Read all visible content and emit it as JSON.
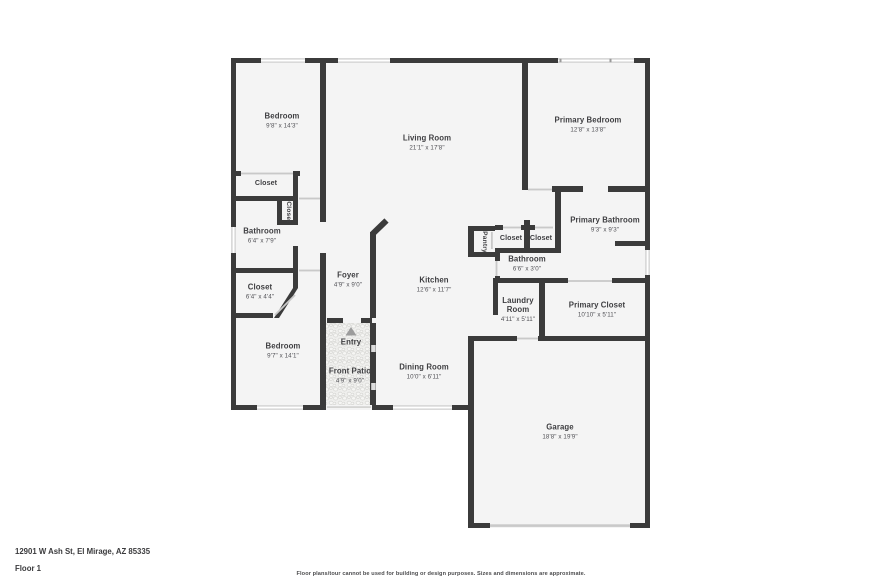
{
  "meta": {
    "address": "12901 W Ash St, El Mirage, AZ 85335",
    "floor_label": "Floor 1",
    "disclaimer": "Floor plans/tour cannot be used for building or design purposes. Sizes and dimensions are approximate."
  },
  "rooms": {
    "bedroom_front": {
      "name": "Bedroom",
      "dims": "9'8\" x 14'3\""
    },
    "living_room": {
      "name": "Living Room",
      "dims": "21'1\" x 17'8\""
    },
    "primary_bedroom": {
      "name": "Primary Bedroom",
      "dims": "12'8\" x 13'8\""
    },
    "bedroom_closet": {
      "name": "Closet"
    },
    "hall_closet_side": {
      "name": "Closet"
    },
    "bathroom_hall": {
      "name": "Bathroom",
      "dims": "6'4\" x 7'9\""
    },
    "closet_hall": {
      "name": "Closet",
      "dims": "6'4\" x 4'4\""
    },
    "bedroom_back": {
      "name": "Bedroom",
      "dims": "9'7\" x 14'1\""
    },
    "foyer": {
      "name": "Foyer",
      "dims": "4'9\" x 9'0\""
    },
    "entry": {
      "name": "Entry"
    },
    "front_patio": {
      "name": "Front Patio",
      "dims": "4'9\" x 9'0\""
    },
    "kitchen": {
      "name": "Kitchen",
      "dims": "12'6\" x 11'7\""
    },
    "dining_room": {
      "name": "Dining Room",
      "dims": "10'0\" x 6'11\""
    },
    "pantry": {
      "name": "Pantry"
    },
    "closet_a": {
      "name": "Closet"
    },
    "closet_b": {
      "name": "Closet"
    },
    "bathroom_small": {
      "name": "Bathroom",
      "dims": "6'6\" x 3'0\""
    },
    "primary_bathroom": {
      "name": "Primary Bathroom",
      "dims": "9'3\" x 9'3\""
    },
    "laundry_room": {
      "name": "Laundry Room",
      "dims": "4'11\" x 5'11\""
    },
    "primary_closet": {
      "name": "Primary Closet",
      "dims": "10'10\" x 5'11\""
    },
    "garage": {
      "name": "Garage",
      "dims": "18'8\" x 19'9\""
    }
  },
  "colors": {
    "wall": "#3b3b3b",
    "room_fill": "#f4f4f4",
    "window": "#d9d9d9",
    "door_line": "#c9c9c9",
    "entry_arrow": "#9c9c9c",
    "label_text": "#3e3e41"
  }
}
